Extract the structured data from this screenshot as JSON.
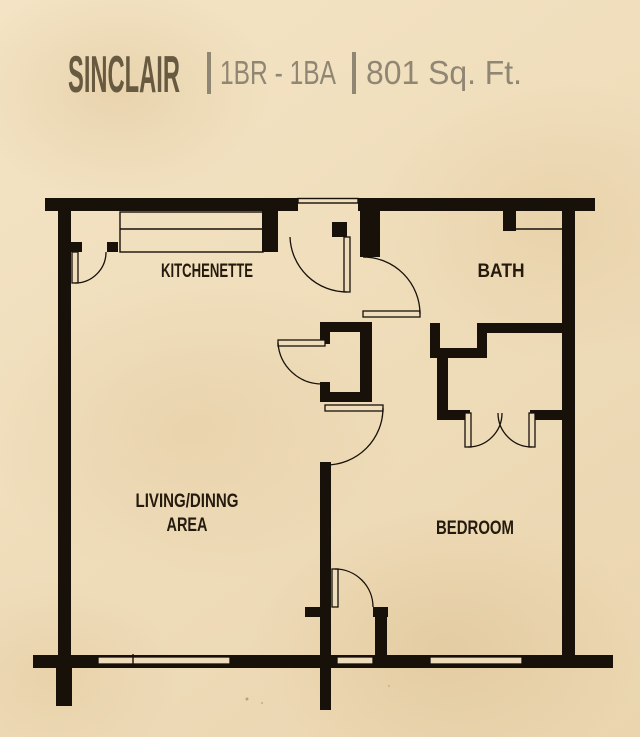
{
  "header": {
    "plan_name": "SINCLAIR",
    "bed_bath": "1BR - 1BA",
    "area": "801 Sq. Ft."
  },
  "rooms": {
    "kitchenette": "KITCHENETTE",
    "bath": "BATH",
    "living_line1": "LIVING/DINNG",
    "living_line2": "AREA",
    "bedroom": "BEDROOM"
  },
  "colors": {
    "background": "#eedcba",
    "wall": "#17110a",
    "title_primary": "#675a41",
    "title_secondary": "#8f8673",
    "room_label": "#241a0e"
  }
}
